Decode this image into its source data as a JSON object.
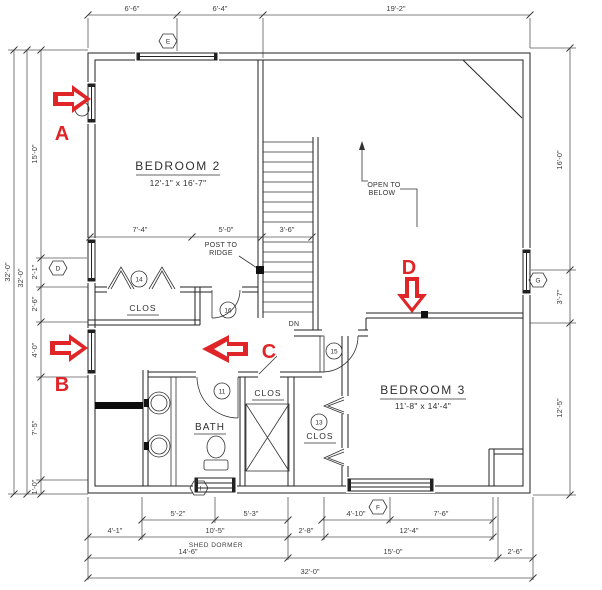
{
  "drawing": {
    "rooms": {
      "bedroom2": {
        "name": "BEDROOM 2",
        "size": "12'-1\" x 16'-7\""
      },
      "bedroom3": {
        "name": "BEDROOM 3",
        "size": "11'-8\" x 14'-4\""
      },
      "bath": {
        "name": "BATH"
      },
      "closet_bedroom2": {
        "name": "CLOS"
      },
      "closet_linen": {
        "name": "CLOS"
      },
      "closet_bedroom3": {
        "name": "CLOS"
      },
      "open_to_below": {
        "line1": "OPEN TO",
        "line2": "BELOW"
      },
      "stairs": {
        "down_label": "DN"
      }
    },
    "notes": {
      "post_to_ridge_line1": "POST TO",
      "post_to_ridge_line2": "RIDGE",
      "shed_dormer": "SHED DORMER"
    },
    "door_marks": {
      "d11": "11",
      "d13": "13",
      "d14": "14",
      "d15": "15",
      "d16": "16"
    },
    "window_marks": {
      "top": "E",
      "left": "D",
      "right": "G",
      "bath": "H",
      "bedroom3": "F"
    },
    "dims": {
      "top": [
        "6'-6\"",
        "6'-4\"",
        "19'-2\""
      ],
      "left": [
        "15'-0\"",
        "2'-1\"",
        "2'-6\"",
        "4'-0\"",
        "7'-5\"",
        "1'-0\""
      ],
      "left_overall": [
        "32'-0\"",
        "32'-0\""
      ],
      "right": [
        "16'-0\"",
        "3'-7\"",
        "12'-5\""
      ],
      "interior": [
        "7'-4\"",
        "5'-0\"",
        "3'-6\""
      ],
      "bottom_row1": [
        "5'-2\"",
        "5'-3\"",
        "4'-10\"",
        "7'-6\""
      ],
      "bottom_row2": [
        "4'-1\"",
        "10'-5\"",
        "2'-8\"",
        "12'-4\""
      ],
      "bottom_row3": [
        "14'-6\"",
        "15'-0\"",
        "2'-6\""
      ],
      "bottom_overall": "32'-0\""
    },
    "annotations": {
      "a": "A",
      "b": "B",
      "c": "C",
      "d": "D"
    },
    "palette": {
      "annotation_red": "#e02528",
      "line": "#222222"
    }
  }
}
